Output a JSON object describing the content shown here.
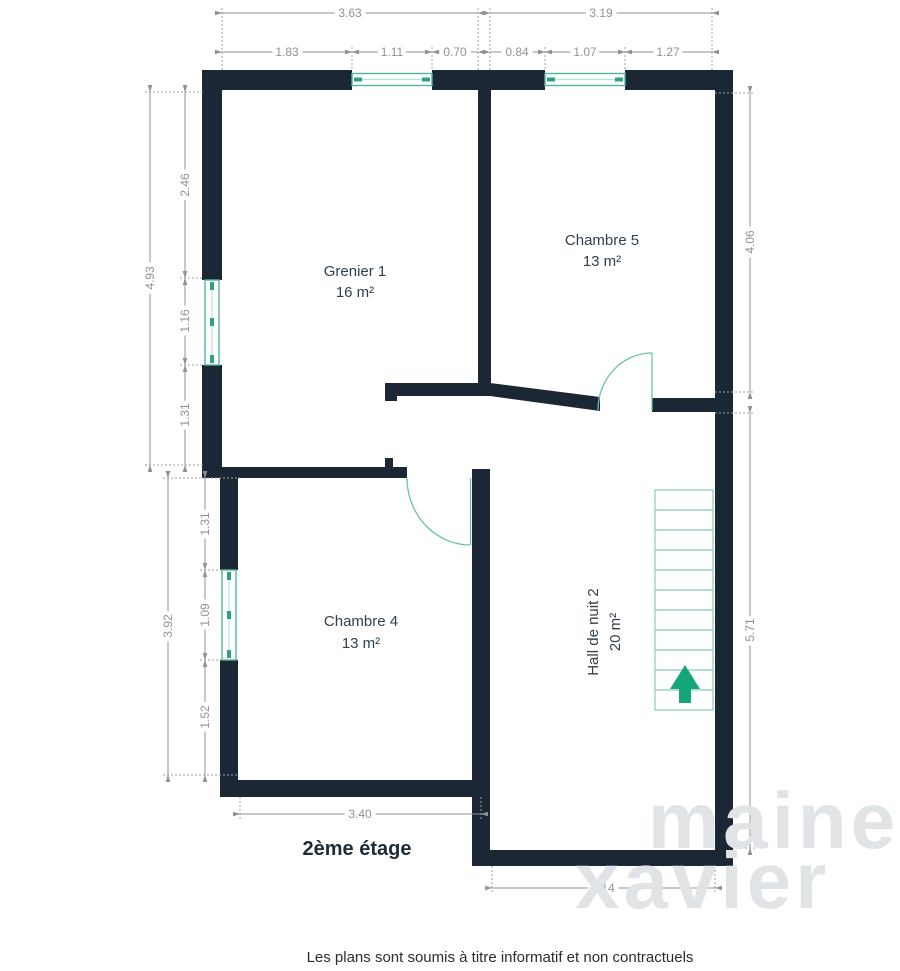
{
  "floor": {
    "label": "2ème étage"
  },
  "disclaimer": "Les plans sont soumis à titre informatif et non contractuels",
  "watermark": {
    "line1": "maine",
    "line2": "xavier"
  },
  "rooms": [
    {
      "name": "Grenier 1",
      "area": "16 m²"
    },
    {
      "name": "Chambre 5",
      "area": "13 m²"
    },
    {
      "name": "Chambre 4",
      "area": "13 m²"
    },
    {
      "name": "Hall de nuit 2",
      "area": "20 m²"
    }
  ],
  "dims": {
    "t1": "3.63",
    "t2": "1.83",
    "t3": "1.11",
    "t4": "0.70",
    "t5": "3.19",
    "t6": "0.84",
    "t7": "1.07",
    "t8": "1.27",
    "l1": "4.93",
    "l2": "2.46",
    "l3": "1.16",
    "l4": "1.31",
    "l5": "3.92",
    "l6": "1.31",
    "l7": "1.09",
    "l8": "1.52",
    "r1": "4.06",
    "r2": "5.71",
    "b1": "3.40",
    "b2": "3.14"
  },
  "colors": {
    "wall": "#1b2735",
    "dimension": "#8e9297",
    "window_teal": "#53b69c",
    "door_teal": "#6cc2ac",
    "stair_teal": "#86ccb9",
    "arrow_green": "#14a57b",
    "label_text": "#323f4e"
  }
}
